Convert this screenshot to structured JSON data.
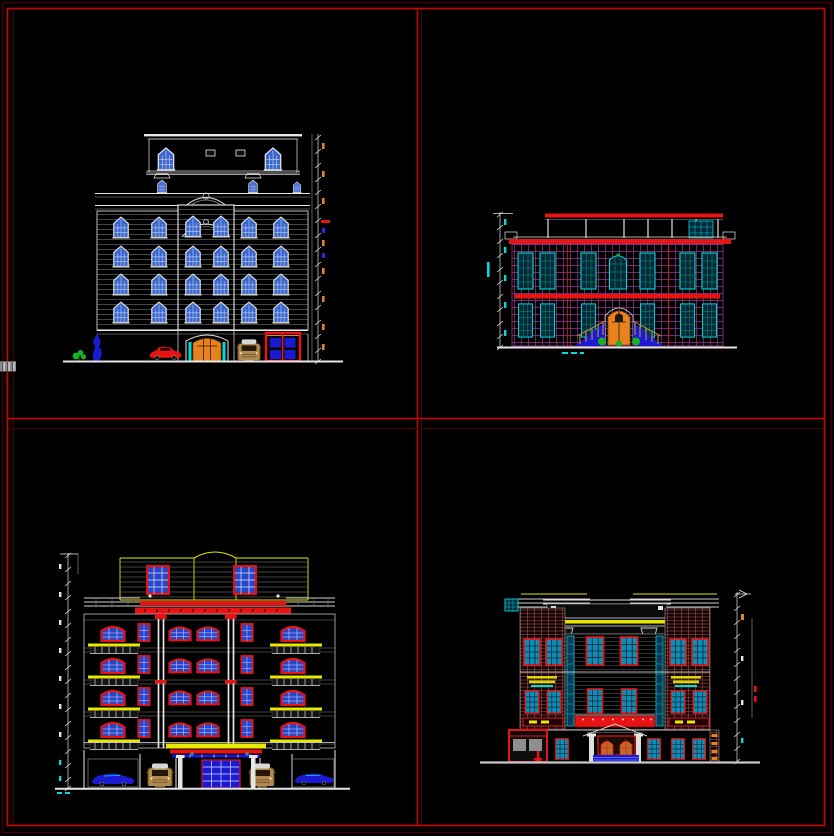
{
  "canvas": {
    "width": 834,
    "height": 836,
    "background": "#000000"
  },
  "palette": {
    "bg": "#000000",
    "border_red": "#d40000",
    "border_dark_red": "#4a0000",
    "line_white": "#e6e6e6",
    "line_gray": "#9a9a9a",
    "band_gray": "#464646",
    "red": "#e81414",
    "dark_red": "#7a0808",
    "yellow": "#e8e800",
    "orange": "#e8821e",
    "cyan": "#00dcdc",
    "magenta": "#9a3590",
    "glass_blue": "#3a66cc",
    "glass_cyan": "#128cb4",
    "deep_blue": "#1a1ad2",
    "navy": "#06283a",
    "green": "#16b224",
    "tan": "#b08a50",
    "brick": "#a85454",
    "panel_gray": "#8f8f8f"
  },
  "drawings": {
    "top_left": {
      "name": "front elevation - six storey block",
      "line_style": "white outline with blue glazing",
      "floors": 6,
      "features": [
        "penthouse",
        "arched parapet",
        "four window floors",
        "arched entrance door",
        "red car",
        "tan car",
        "garage door with blue panels",
        "shrub",
        "blue tree",
        "dimension line right"
      ]
    },
    "top_right": {
      "name": "side elevation - two storey block",
      "line_style": "magenta facade grid, red cornices",
      "floors": 2,
      "features": [
        "roof pergola",
        "stair bulkhead",
        "cyan windows",
        "orange arched door",
        "blue entry ramps",
        "shrubs",
        "dimension line left"
      ]
    },
    "bottom_left": {
      "name": "front elevation - five storey block",
      "line_style": "red window frames, yellow balconies",
      "floors": 6,
      "features": [
        "yellow penthouse",
        "red cornice",
        "white columns",
        "balconies",
        "parking bays",
        "blue cars",
        "tan cars",
        "blue entrance door",
        "dimension line left"
      ]
    },
    "bottom_right": {
      "name": "rear elevation - three storey block",
      "line_style": "brick banding, red frames, cyan glazing",
      "floors": 3,
      "features": [
        "yellow parapet",
        "raised centre bay",
        "glazing strips",
        "red balcony banner",
        "garage with down arrow",
        "arched twin door",
        "blue steps",
        "dimension line right"
      ]
    }
  }
}
